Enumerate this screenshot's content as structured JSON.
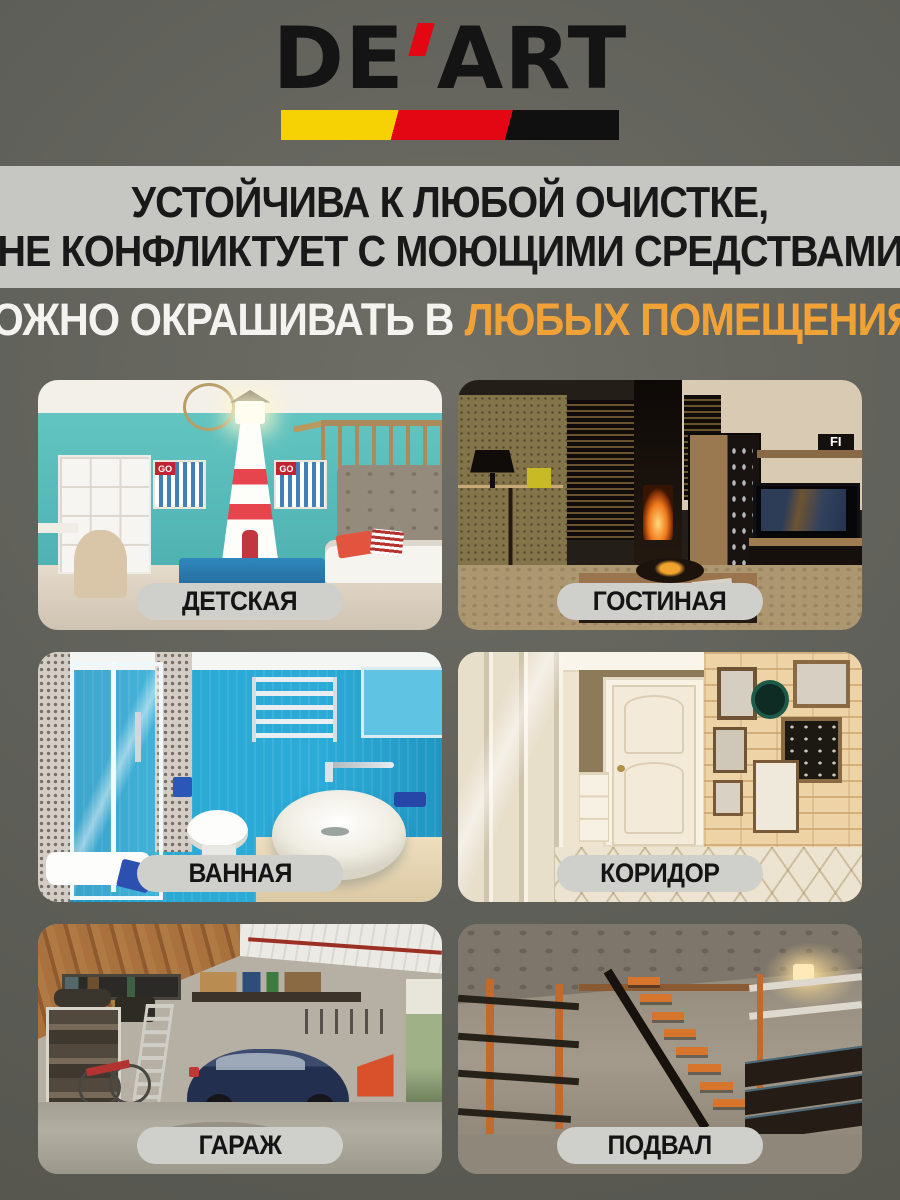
{
  "brand": {
    "name_left": "DE",
    "name_right": "ART",
    "apostrophe_color": "#e30613",
    "stripe_colors": [
      "#f6d204",
      "#e30613",
      "#101010"
    ]
  },
  "headline": {
    "line1": "УСТОЙЧИВА К ЛЮБОЙ ОЧИСТКЕ,",
    "line2": "НЕ КОНФЛИКТУЕТ С МОЮЩИМИ СРЕДСТВАМИ",
    "band_bg": "#c6c7c2",
    "text_color": "#191919"
  },
  "subheadline": {
    "white_part": "МОЖНО ОКРАШИВАТЬ В",
    "orange_part": "ЛЮБЫХ ПОМЕЩЕНИЯХ",
    "orange_color": "#f1a237"
  },
  "rooms": [
    {
      "label": "ДЕТСКАЯ"
    },
    {
      "label": "ГОСТИНАЯ"
    },
    {
      "label": "ВАННАЯ"
    },
    {
      "label": "КОРИДОР"
    },
    {
      "label": "ГАРАЖ"
    },
    {
      "label": "ПОДВАЛ"
    }
  ],
  "photo_details": {
    "kids_box_label": "GO",
    "living_shelf_label": "FI"
  },
  "colors": {
    "page_background": "#5d5d56",
    "badge_background": "#cfd0cb"
  }
}
